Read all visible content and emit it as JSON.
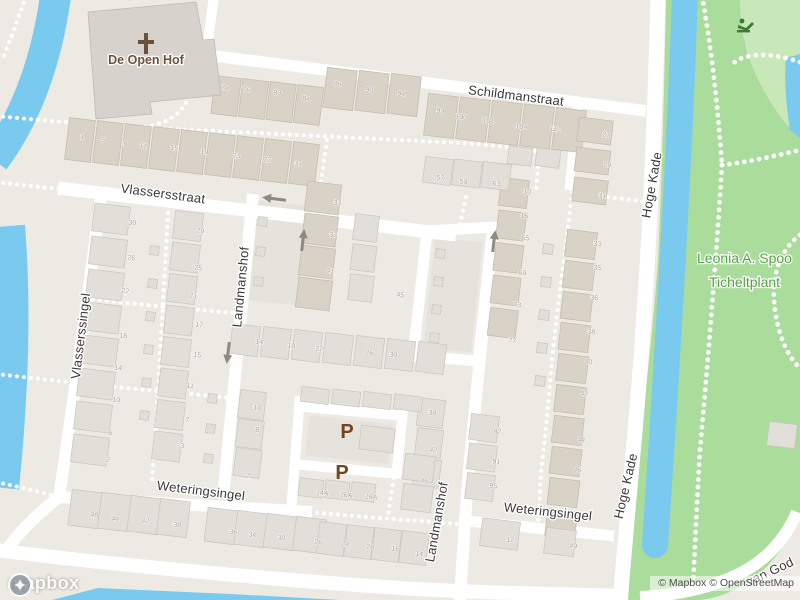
{
  "map": {
    "street_labels": [
      {
        "name": "Schildmanstraat"
      },
      {
        "name": "Vlassersstraat"
      },
      {
        "name": "Vlasserssingel"
      },
      {
        "name": "Landmanshof"
      },
      {
        "name": "Landmanshof"
      },
      {
        "name": "Hoge Kade"
      },
      {
        "name": "Hoge Kade"
      },
      {
        "name": "Weteringsingel"
      },
      {
        "name": "Weteringsingel"
      },
      {
        "name": "van God"
      }
    ],
    "pois": {
      "church_name": "De Open Hof",
      "park_name_line1": "Leonia A. Spoo",
      "park_name_line2": "Ticheltplant"
    },
    "parking": {
      "symbol1": "P",
      "symbol2": "P"
    },
    "attribution": {
      "logo": "mapbox",
      "mapbox": "© Mapbox",
      "osm": "© OpenStreetMap"
    },
    "colors": {
      "land": "#EDEAE4",
      "water": "#7AC9EE",
      "park": "#AADC9C",
      "park_light": "#C9E8BA",
      "building": "#E2DFD9",
      "building_tan": "#D9D2C7",
      "street_label": "#3A3A3A",
      "house_number": "#A09C93",
      "park_label": "#55A045",
      "poi_brown": "#6B523C",
      "parking_brown": "#74431F",
      "arrow": "#8D8A82"
    },
    "house_numbers": [
      {
        "n": "74",
        "x": 225,
        "y": 90
      },
      {
        "n": "76",
        "x": 246,
        "y": 92
      },
      {
        "n": "80",
        "x": 277,
        "y": 95
      },
      {
        "n": "84",
        "x": 306,
        "y": 101
      },
      {
        "n": "86",
        "x": 337,
        "y": 86
      },
      {
        "n": "90",
        "x": 369,
        "y": 92
      },
      {
        "n": "94",
        "x": 401,
        "y": 96
      },
      {
        "n": "99",
        "x": 440,
        "y": 113
      },
      {
        "n": "100",
        "x": 461,
        "y": 119
      },
      {
        "n": "104",
        "x": 488,
        "y": 123
      },
      {
        "n": "109",
        "x": 521,
        "y": 129
      },
      {
        "n": "112",
        "x": 555,
        "y": 131
      },
      {
        "n": "27",
        "x": 606,
        "y": 137
      },
      {
        "n": "29",
        "x": 607,
        "y": 167
      },
      {
        "n": "31",
        "x": 602,
        "y": 198
      },
      {
        "n": "1",
        "x": 82,
        "y": 139
      },
      {
        "n": "5",
        "x": 103,
        "y": 142
      },
      {
        "n": "9",
        "x": 125,
        "y": 146
      },
      {
        "n": "11",
        "x": 143,
        "y": 148
      },
      {
        "n": "15",
        "x": 174,
        "y": 150
      },
      {
        "n": "19",
        "x": 204,
        "y": 154
      },
      {
        "n": "23",
        "x": 236,
        "y": 158
      },
      {
        "n": "27",
        "x": 267,
        "y": 162
      },
      {
        "n": "31",
        "x": 298,
        "y": 166
      },
      {
        "n": "57",
        "x": 440,
        "y": 180
      },
      {
        "n": "59",
        "x": 463,
        "y": 184
      },
      {
        "n": "63",
        "x": 496,
        "y": 186
      },
      {
        "n": "10",
        "x": 527,
        "y": 194
      },
      {
        "n": "16",
        "x": 524,
        "y": 218
      },
      {
        "n": "33",
        "x": 337,
        "y": 205
      },
      {
        "n": "37",
        "x": 333,
        "y": 237
      },
      {
        "n": "41",
        "x": 330,
        "y": 273
      },
      {
        "n": "45",
        "x": 400,
        "y": 297
      },
      {
        "n": "65",
        "x": 525,
        "y": 240
      },
      {
        "n": "69",
        "x": 522,
        "y": 275
      },
      {
        "n": "73",
        "x": 517,
        "y": 307
      },
      {
        "n": "77",
        "x": 512,
        "y": 343
      },
      {
        "n": "30",
        "x": 132,
        "y": 225
      },
      {
        "n": "26",
        "x": 131,
        "y": 260
      },
      {
        "n": "22",
        "x": 125,
        "y": 293
      },
      {
        "n": "18",
        "x": 123,
        "y": 338
      },
      {
        "n": "14",
        "x": 118,
        "y": 370
      },
      {
        "n": "10",
        "x": 116,
        "y": 402
      },
      {
        "n": "6",
        "x": 110,
        "y": 435
      },
      {
        "n": "2",
        "x": 108,
        "y": 462
      },
      {
        "n": "29",
        "x": 200,
        "y": 233
      },
      {
        "n": "25",
        "x": 198,
        "y": 270
      },
      {
        "n": "21",
        "x": 193,
        "y": 298
      },
      {
        "n": "17",
        "x": 199,
        "y": 327
      },
      {
        "n": "15",
        "x": 197,
        "y": 357
      },
      {
        "n": "11",
        "x": 190,
        "y": 388
      },
      {
        "n": "7",
        "x": 187,
        "y": 422
      },
      {
        "n": "3",
        "x": 182,
        "y": 448
      },
      {
        "n": "33",
        "x": 597,
        "y": 246
      },
      {
        "n": "35",
        "x": 597,
        "y": 270
      },
      {
        "n": "36",
        "x": 594,
        "y": 300
      },
      {
        "n": "38",
        "x": 591,
        "y": 334
      },
      {
        "n": "40",
        "x": 588,
        "y": 364
      },
      {
        "n": "42",
        "x": 584,
        "y": 396
      },
      {
        "n": "44",
        "x": 581,
        "y": 442
      },
      {
        "n": "46",
        "x": 577,
        "y": 472
      },
      {
        "n": "49",
        "x": 573,
        "y": 548
      },
      {
        "n": "14",
        "x": 259,
        "y": 344
      },
      {
        "n": "18",
        "x": 291,
        "y": 348
      },
      {
        "n": "22",
        "x": 319,
        "y": 351
      },
      {
        "n": "26",
        "x": 369,
        "y": 355
      },
      {
        "n": "30",
        "x": 393,
        "y": 357
      },
      {
        "n": "10",
        "x": 257,
        "y": 410
      },
      {
        "n": "8",
        "x": 257,
        "y": 432
      },
      {
        "n": "2",
        "x": 248,
        "y": 478
      },
      {
        "n": "38",
        "x": 432,
        "y": 415
      },
      {
        "n": "42",
        "x": 433,
        "y": 452
      },
      {
        "n": "46",
        "x": 424,
        "y": 483
      },
      {
        "n": "14A",
        "x": 322,
        "y": 495
      },
      {
        "n": "16A",
        "x": 346,
        "y": 497
      },
      {
        "n": "18A",
        "x": 371,
        "y": 499
      },
      {
        "n": "48",
        "x": 94,
        "y": 517
      },
      {
        "n": "44",
        "x": 115,
        "y": 521
      },
      {
        "n": "42",
        "x": 145,
        "y": 523
      },
      {
        "n": "38",
        "x": 177,
        "y": 527
      },
      {
        "n": "36",
        "x": 233,
        "y": 534
      },
      {
        "n": "34",
        "x": 252,
        "y": 537
      },
      {
        "n": "30",
        "x": 281,
        "y": 540
      },
      {
        "n": "26",
        "x": 318,
        "y": 544
      },
      {
        "n": "24",
        "x": 345,
        "y": 546
      },
      {
        "n": "20",
        "x": 370,
        "y": 549
      },
      {
        "n": "16",
        "x": 395,
        "y": 551
      },
      {
        "n": "14",
        "x": 419,
        "y": 556
      },
      {
        "n": "87",
        "x": 497,
        "y": 434
      },
      {
        "n": "91",
        "x": 496,
        "y": 464
      },
      {
        "n": "95",
        "x": 493,
        "y": 488
      },
      {
        "n": "12",
        "x": 510,
        "y": 542
      }
    ]
  }
}
